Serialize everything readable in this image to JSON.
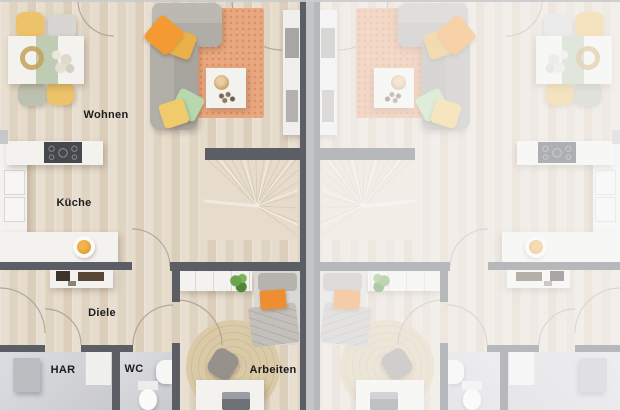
{
  "floorplan": {
    "type": "residential-floor-plan",
    "rooms": {
      "living": "Wohnen",
      "kitchen": "Küche",
      "hallway": "Diele",
      "utility": "HAR",
      "wc": "WC",
      "office": "Arbeiten"
    },
    "units": [
      {
        "id": "unit-left",
        "labels_visible": true,
        "mirrored": false,
        "faded": false
      },
      {
        "id": "unit-right",
        "labels_visible": false,
        "mirrored": true,
        "faded": true
      }
    ],
    "colors": {
      "wall_dark": "#5b5e64",
      "wall_light": "#c6c7c9",
      "floor_wood": "#e3d8c8",
      "floor_tile": "#d4d5d8",
      "rug_terracotta": "#e9a87f",
      "rug_jute": "#d9c9a6",
      "accent_orange": "#f49a32",
      "accent_yellow": "#edc369",
      "accent_mint": "#b7d9ad",
      "accent_sage": "#b9c7ac",
      "fade_overlay_opacity": 0.58
    }
  }
}
